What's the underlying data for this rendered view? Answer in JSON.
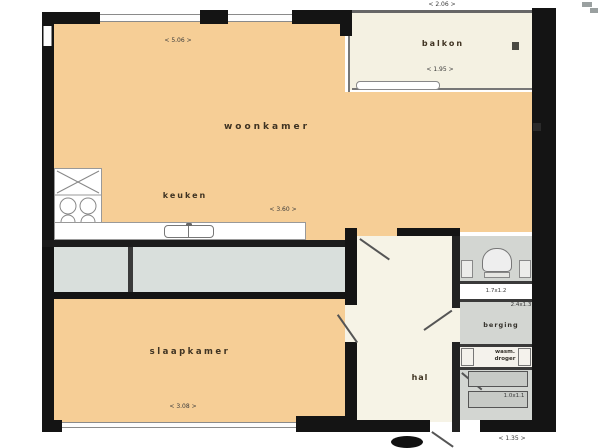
{
  "plan_type": "apartment-floorplan",
  "rooms": {
    "living": {
      "label": "woonkamer",
      "dim": "< 5.06 >"
    },
    "kitchen": {
      "label": "keuken",
      "dim": "< 3.60 >"
    },
    "bedroom": {
      "label": "slaapkamer",
      "dim": "< 3.08 >"
    },
    "balcony": {
      "label": "balkon",
      "dim_outside": "< 2.06 >",
      "dim_inside": "< 1.95 >"
    },
    "hall": {
      "label": "hal"
    },
    "storage": {
      "label": "berging",
      "dim": "2.4x1.3",
      "niche_dim": "1.7x1.2"
    },
    "utility": {
      "washer_label": "wasm.",
      "dryer_label": "droger",
      "dim": "1.0x1.1"
    },
    "entrance": {
      "dim": "< 1.35 >"
    }
  },
  "fixtures": {
    "stove": "stove-burners-icon",
    "counter": "kitchen-counter",
    "sink": "kitchen-sink-icon",
    "toilet": "toilet-icon",
    "sliding_door": "sliding-door",
    "radiator": "radiator-vent-icon",
    "washer": "washing-machine-box",
    "dryer": "dryer-box"
  },
  "colors": {
    "room_fill": "#f6ce96",
    "circulation_fill": "#f5f2e3",
    "balcony_strip_fill": "#d9dfdc",
    "storage_fill": "#d3d6d2",
    "wall": "#141414"
  }
}
